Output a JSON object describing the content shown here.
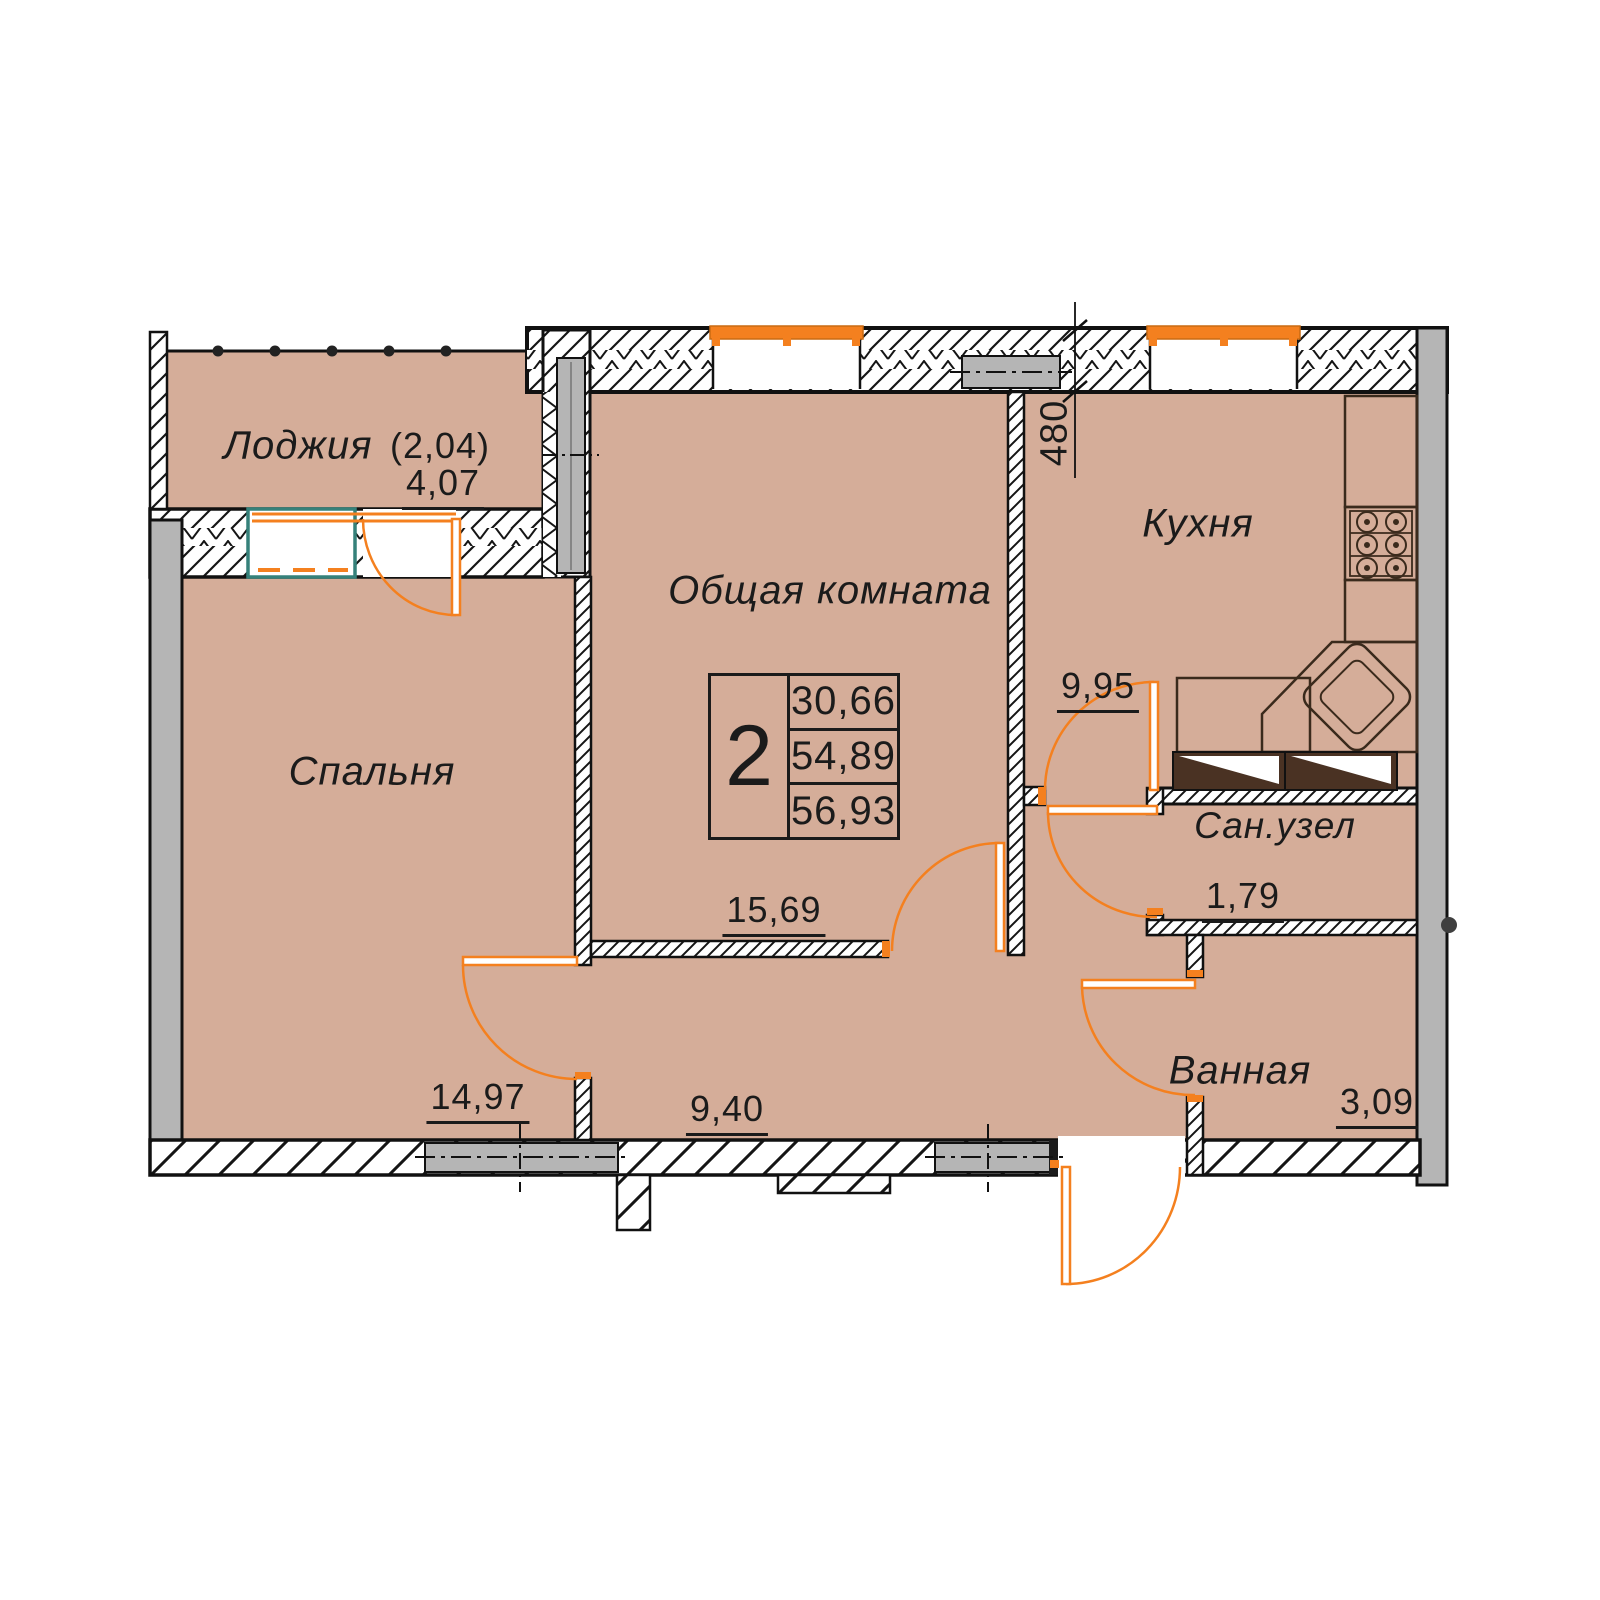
{
  "rooms": {
    "loggia": {
      "label": "Лоджия",
      "coeff": "(2,04)",
      "area": "4,07"
    },
    "bedroom": {
      "label": "Спальня",
      "area": "14,97"
    },
    "living": {
      "label": "Общая комната",
      "area": "15,69"
    },
    "kitchen": {
      "label": "Кухня",
      "area": "9,95"
    },
    "wc": {
      "label": "Сан.узел",
      "area": "1,79"
    },
    "bath": {
      "label": "Ванная",
      "area": "3,09"
    },
    "hall": {
      "area": "9,40"
    }
  },
  "info_box": {
    "rooms_count": "2",
    "areas": [
      "30,66",
      "54,89",
      "56,93"
    ]
  },
  "dimensions": {
    "wall_thickness": "480"
  },
  "colors": {
    "floor_tan": "#d5ad99",
    "wall_gray": "#b5b5b5",
    "accent_orange": "#f4801f",
    "window_teal": "#35817a",
    "cabinet_brown": "#4a3223",
    "line_black": "#1b1b1b"
  }
}
